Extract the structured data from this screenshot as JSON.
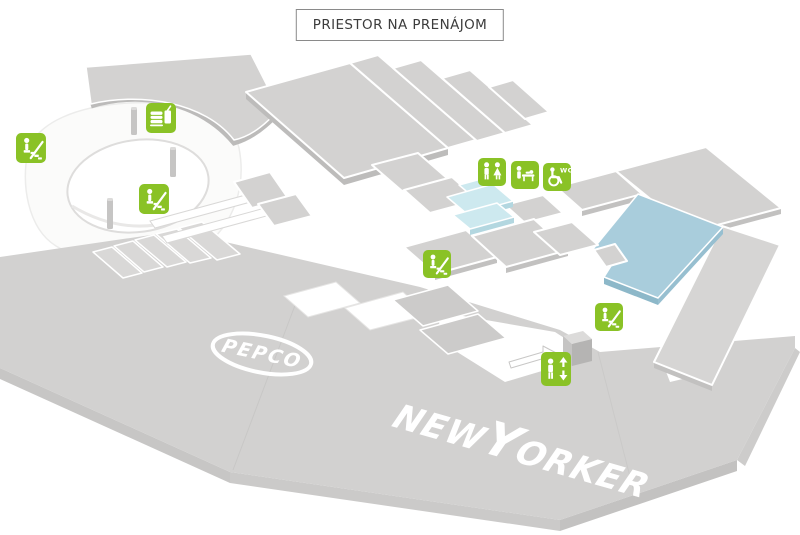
{
  "title": {
    "label": "PRIESTOR NA PRENÁJOM"
  },
  "legend": {
    "unit_color": "#d3d2d1",
    "available_small_color": "#cde9ef",
    "available_large_color": "#a9cddc",
    "icon_color": "#8ac226"
  },
  "logos": {
    "pepco": "PEPCO",
    "new_yorker": {
      "new": "NEW",
      "y": "Y",
      "orker": "ORKER"
    }
  },
  "labels": {
    "wc": "WC"
  },
  "icons": [
    {
      "name": "escalator-icon"
    },
    {
      "name": "food-court-icon"
    },
    {
      "name": "escalator-icon"
    },
    {
      "name": "wc-icon"
    },
    {
      "name": "baby-changing-icon"
    },
    {
      "name": "accessible-wc-icon"
    },
    {
      "name": "escalator-icon"
    },
    {
      "name": "escalator-icon"
    },
    {
      "name": "elevator-icon"
    }
  ]
}
